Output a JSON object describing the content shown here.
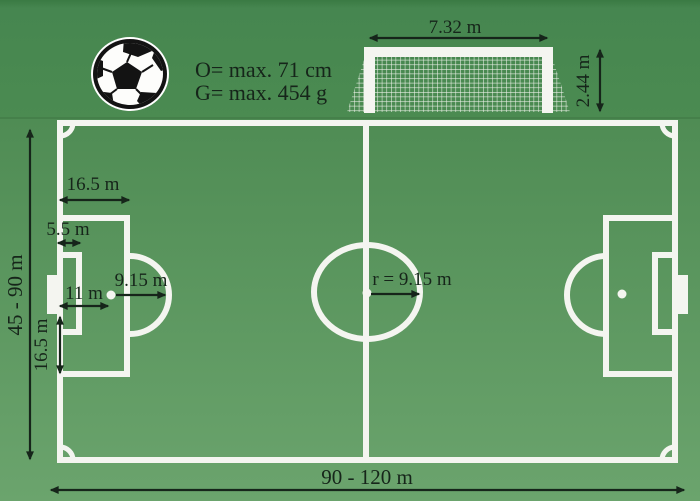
{
  "title": "Football pitch dimensions diagram",
  "ball_specs": {
    "circumference": "O= max. 71 cm",
    "weight": "G= max. 454 g"
  },
  "goal": {
    "width": "7.32 m",
    "height": "2.44 m"
  },
  "pitch": {
    "length": "90 - 120 m",
    "width": "45 - 90 m",
    "penalty_area_depth": "16.5 m",
    "goal_area_depth": "5.5 m",
    "penalty_arc_radius": "9.15 m",
    "penalty_spot_distance": "11 m",
    "penalty_area_extent": "16.5 m",
    "center_circle_radius": "r = 9.15 m"
  },
  "colors": {
    "field_green": "#4f9d57",
    "background_green_top": "#43834b",
    "background_green_bottom": "#6ba46d",
    "line_white": "#f4f5f0",
    "annotation_dark": "#16251a"
  }
}
